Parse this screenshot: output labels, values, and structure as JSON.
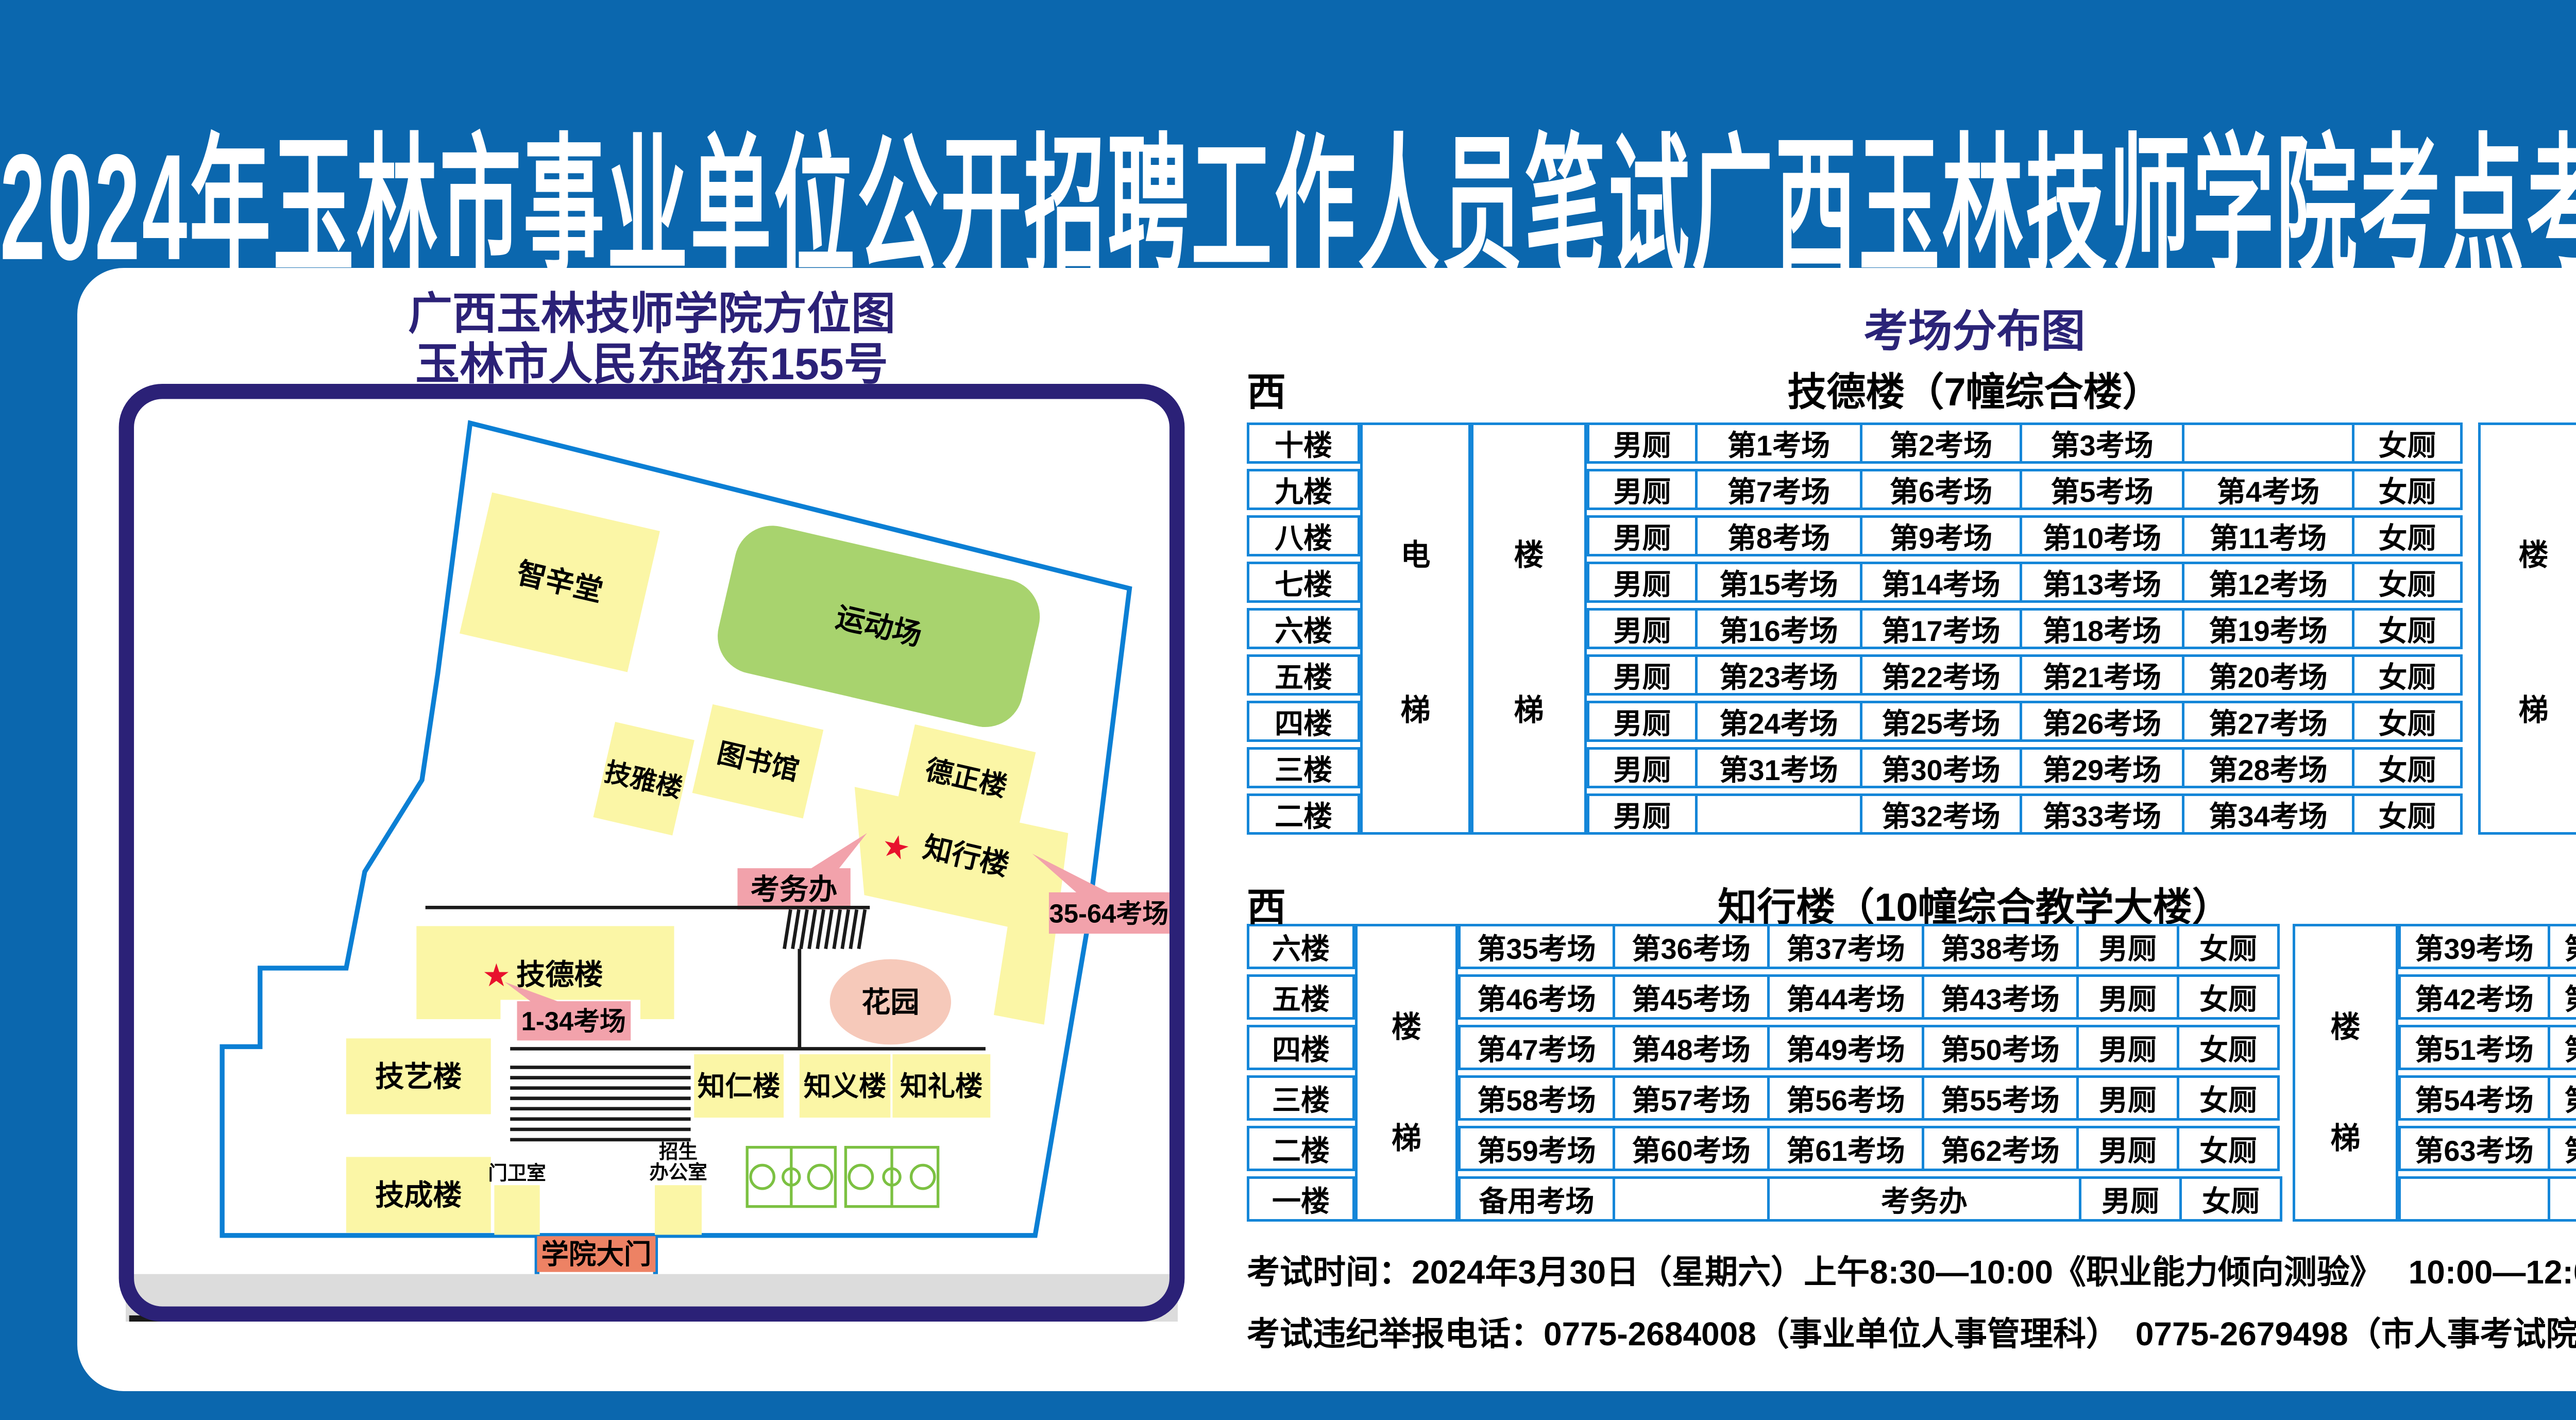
{
  "title": "2024年玉林市事业单位公开招聘工作人员笔试广西玉林技师学院考点考场示意图",
  "compass": {
    "west": "西",
    "east": "东"
  },
  "map": {
    "title_line1": "广西玉林技师学院方位图",
    "title_line2": "玉林市人民东路东155号",
    "buildings": {
      "zhixintang": "智辛堂",
      "sports_field": "运动场",
      "jiyalou": "技雅楼",
      "library": "图书馆",
      "dezhenglou": "德正楼",
      "zhixinglou": "知行楼",
      "jidelou": "技德楼",
      "jiyilou": "技艺楼",
      "zhirenlou": "知仁楼",
      "zhiyilou": "知义楼",
      "zhililou": "知礼楼",
      "jichenglou": "技成楼",
      "gatehouse": "门卫室",
      "admissions_line1": "招生",
      "admissions_line2": "办公室",
      "garden": "花园"
    },
    "labels": {
      "exam_office": "考务办",
      "rooms_35_64": "35-64考场",
      "rooms_1_34": "1-34考场",
      "gate": "学院大门",
      "road": "人民东路",
      "star": "★"
    }
  },
  "distribution": {
    "title": "考场分布图",
    "table1": {
      "name": "技德楼（7幢综合楼）",
      "elevator": [
        "电",
        "梯"
      ],
      "stairs": [
        "楼",
        "梯"
      ],
      "toilet_m": "男厕",
      "toilet_f": "女厕",
      "floors": [
        "十楼",
        "九楼",
        "八楼",
        "七楼",
        "六楼",
        "五楼",
        "四楼",
        "三楼",
        "二楼"
      ],
      "rooms": [
        [
          "第1考场",
          "第2考场",
          "第3考场",
          ""
        ],
        [
          "第7考场",
          "第6考场",
          "第5考场",
          "第4考场"
        ],
        [
          "第8考场",
          "第9考场",
          "第10考场",
          "第11考场"
        ],
        [
          "第15考场",
          "第14考场",
          "第13考场",
          "第12考场"
        ],
        [
          "第16考场",
          "第17考场",
          "第18考场",
          "第19考场"
        ],
        [
          "第23考场",
          "第22考场",
          "第21考场",
          "第20考场"
        ],
        [
          "第24考场",
          "第25考场",
          "第26考场",
          "第27考场"
        ],
        [
          "第31考场",
          "第30考场",
          "第29考场",
          "第28考场"
        ],
        [
          "",
          "第32考场",
          "第33考场",
          "第34考场"
        ]
      ]
    },
    "table2": {
      "name": "知行楼（10幢综合教学大楼）",
      "stairs": [
        "楼",
        "梯"
      ],
      "toilet_m": "男厕",
      "toilet_f": "女厕",
      "floors": [
        "六楼",
        "五楼",
        "四楼",
        "三楼",
        "二楼",
        "一楼"
      ],
      "rooms_left": [
        [
          "第35考场",
          "第36考场",
          "第37考场",
          "第38考场"
        ],
        [
          "第46考场",
          "第45考场",
          "第44考场",
          "第43考场"
        ],
        [
          "第47考场",
          "第48考场",
          "第49考场",
          "第50考场"
        ],
        [
          "第58考场",
          "第57考场",
          "第56考场",
          "第55考场"
        ],
        [
          "第59考场",
          "第60考场",
          "第61考场",
          "第62考场"
        ]
      ],
      "rooms_right": [
        [
          "第39考场",
          "第40考场"
        ],
        [
          "第42考场",
          "第41考场"
        ],
        [
          "第51考场",
          "第52考场"
        ],
        [
          "第54考场",
          "第53考场"
        ],
        [
          "第63考场",
          "第64考场"
        ],
        [
          "",
          ""
        ]
      ],
      "floor1": {
        "backup": "备用考场",
        "empty": "",
        "office": "考务办"
      }
    }
  },
  "footer": {
    "line1": "考试时间：2024年3月30日（星期六）上午8:30—10:00《职业能力倾向测验》　 10:00—12:00《综合应用能力》",
    "line2": "考试违纪举报电话：0775-2684008（事业单位人事管理科）　0775-2679498（市人事考试院）"
  },
  "colors": {
    "background": "#0b67ae",
    "panel": "#ffffff",
    "navy": "#2b2177",
    "table_border": "#1486d8",
    "building_yellow": "#fbf6a6",
    "field_green": "#a8d36e",
    "court_green": "#7cc142",
    "label_pink": "#f2a2ab",
    "garden_pink": "#f6c9ba",
    "gate_salmon": "#ed8264",
    "road_gray": "#dcdcdc",
    "boundary_blue": "#0b7fd4",
    "star_red": "#e8112d"
  }
}
